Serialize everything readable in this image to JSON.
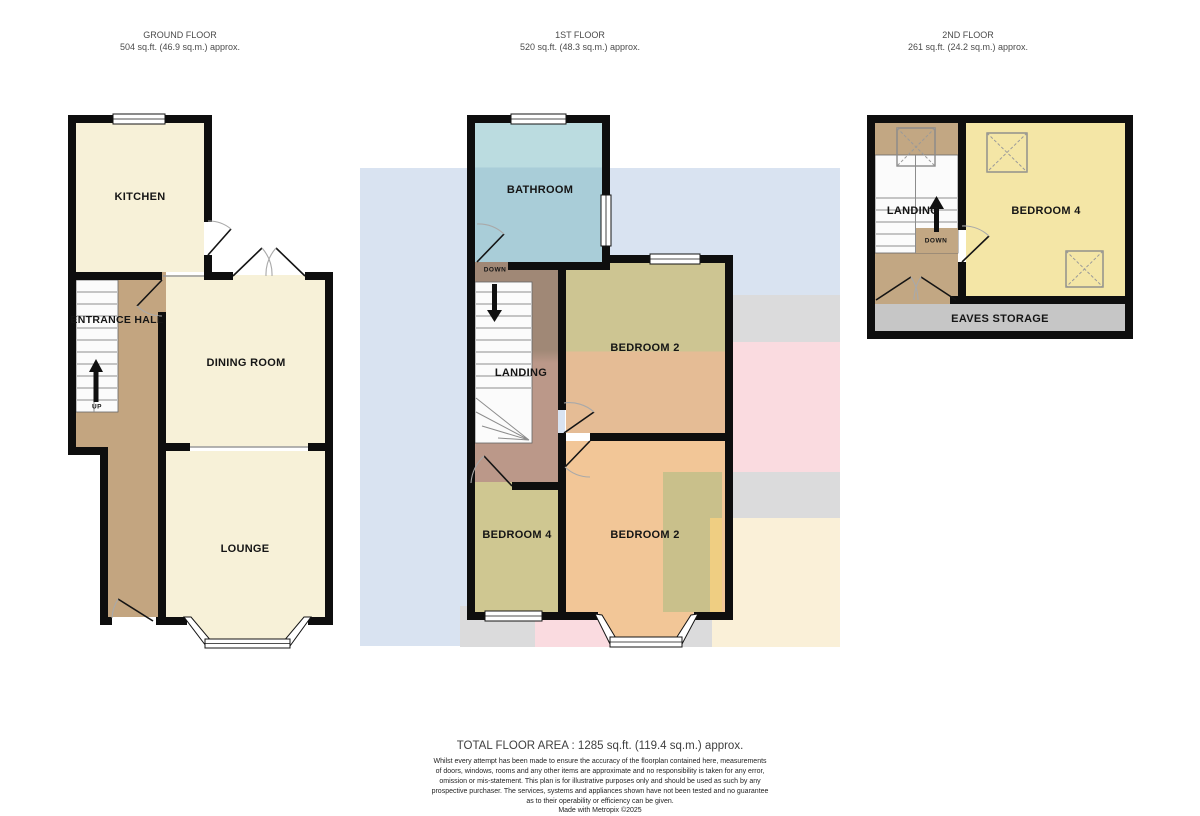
{
  "floors": {
    "ground": {
      "title": "GROUND FLOOR",
      "area": "504 sq.ft. (46.9 sq.m.) approx.",
      "rooms": {
        "kitchen": "KITCHEN",
        "entrance_hall": "ENTRANCE HALL",
        "dining": "DINING ROOM",
        "lounge": "LOUNGE",
        "up": "UP"
      }
    },
    "first": {
      "title": "1ST FLOOR",
      "area": "520 sq.ft. (48.3 sq.m.) approx.",
      "rooms": {
        "bathroom": "BATHROOM",
        "down": "DOWN",
        "bedroom2_top": "BEDROOM 2",
        "landing": "LANDING",
        "bedroom4": "BEDROOM 4",
        "bedroom2_bottom": "BEDROOM 2"
      }
    },
    "second": {
      "title": "2ND FLOOR",
      "area": "261 sq.ft. (24.2 sq.m.) approx.",
      "rooms": {
        "landing": "LANDING",
        "down": "DOWN",
        "bedroom4": "BEDROOM 4",
        "eaves": "EAVES STORAGE"
      }
    }
  },
  "footer": {
    "total": "TOTAL FLOOR AREA : 1285 sq.ft. (119.4 sq.m.) approx.",
    "disclaimer_lines": [
      "Whilst every attempt has been made to ensure the accuracy of the floorplan contained here, measurements",
      "of doors, windows, rooms and any other items are approximate and no responsibility is taken for any error,",
      "omission or mis-statement. This plan is for illustrative purposes only and should be used as such by any",
      "prospective purchaser. The services, systems and appliances shown have not been tested and no guarantee",
      "as to their operability or efficiency can be given."
    ],
    "credit": "Made with Metropix ©2025"
  },
  "palette": {
    "wall": "#0e0e0e",
    "cream": "#F7F1D8",
    "tan": "#C3A580",
    "tan2": "#C2A783",
    "stair": "#FBFBFB",
    "blueTop": "#BBDCE0",
    "blueMain": "#A9CDD8",
    "khakiTop": "#CDC592",
    "salmon": "#E5BC95",
    "orange": "#F2C697",
    "khakiRoom": "#CFC791",
    "khaki2": "#C9C08B",
    "ystrip": "#EFCE82",
    "brown1": "#A08876",
    "brown2": "#BB9889",
    "bed4y": "#F4E6A6",
    "eaves": "#C6C6C6",
    "ovblue": "#D9E3F1",
    "ovgray": "#DBDBDC",
    "ovpink": "#FADBE0",
    "ovcream": "#FAF0D8"
  }
}
